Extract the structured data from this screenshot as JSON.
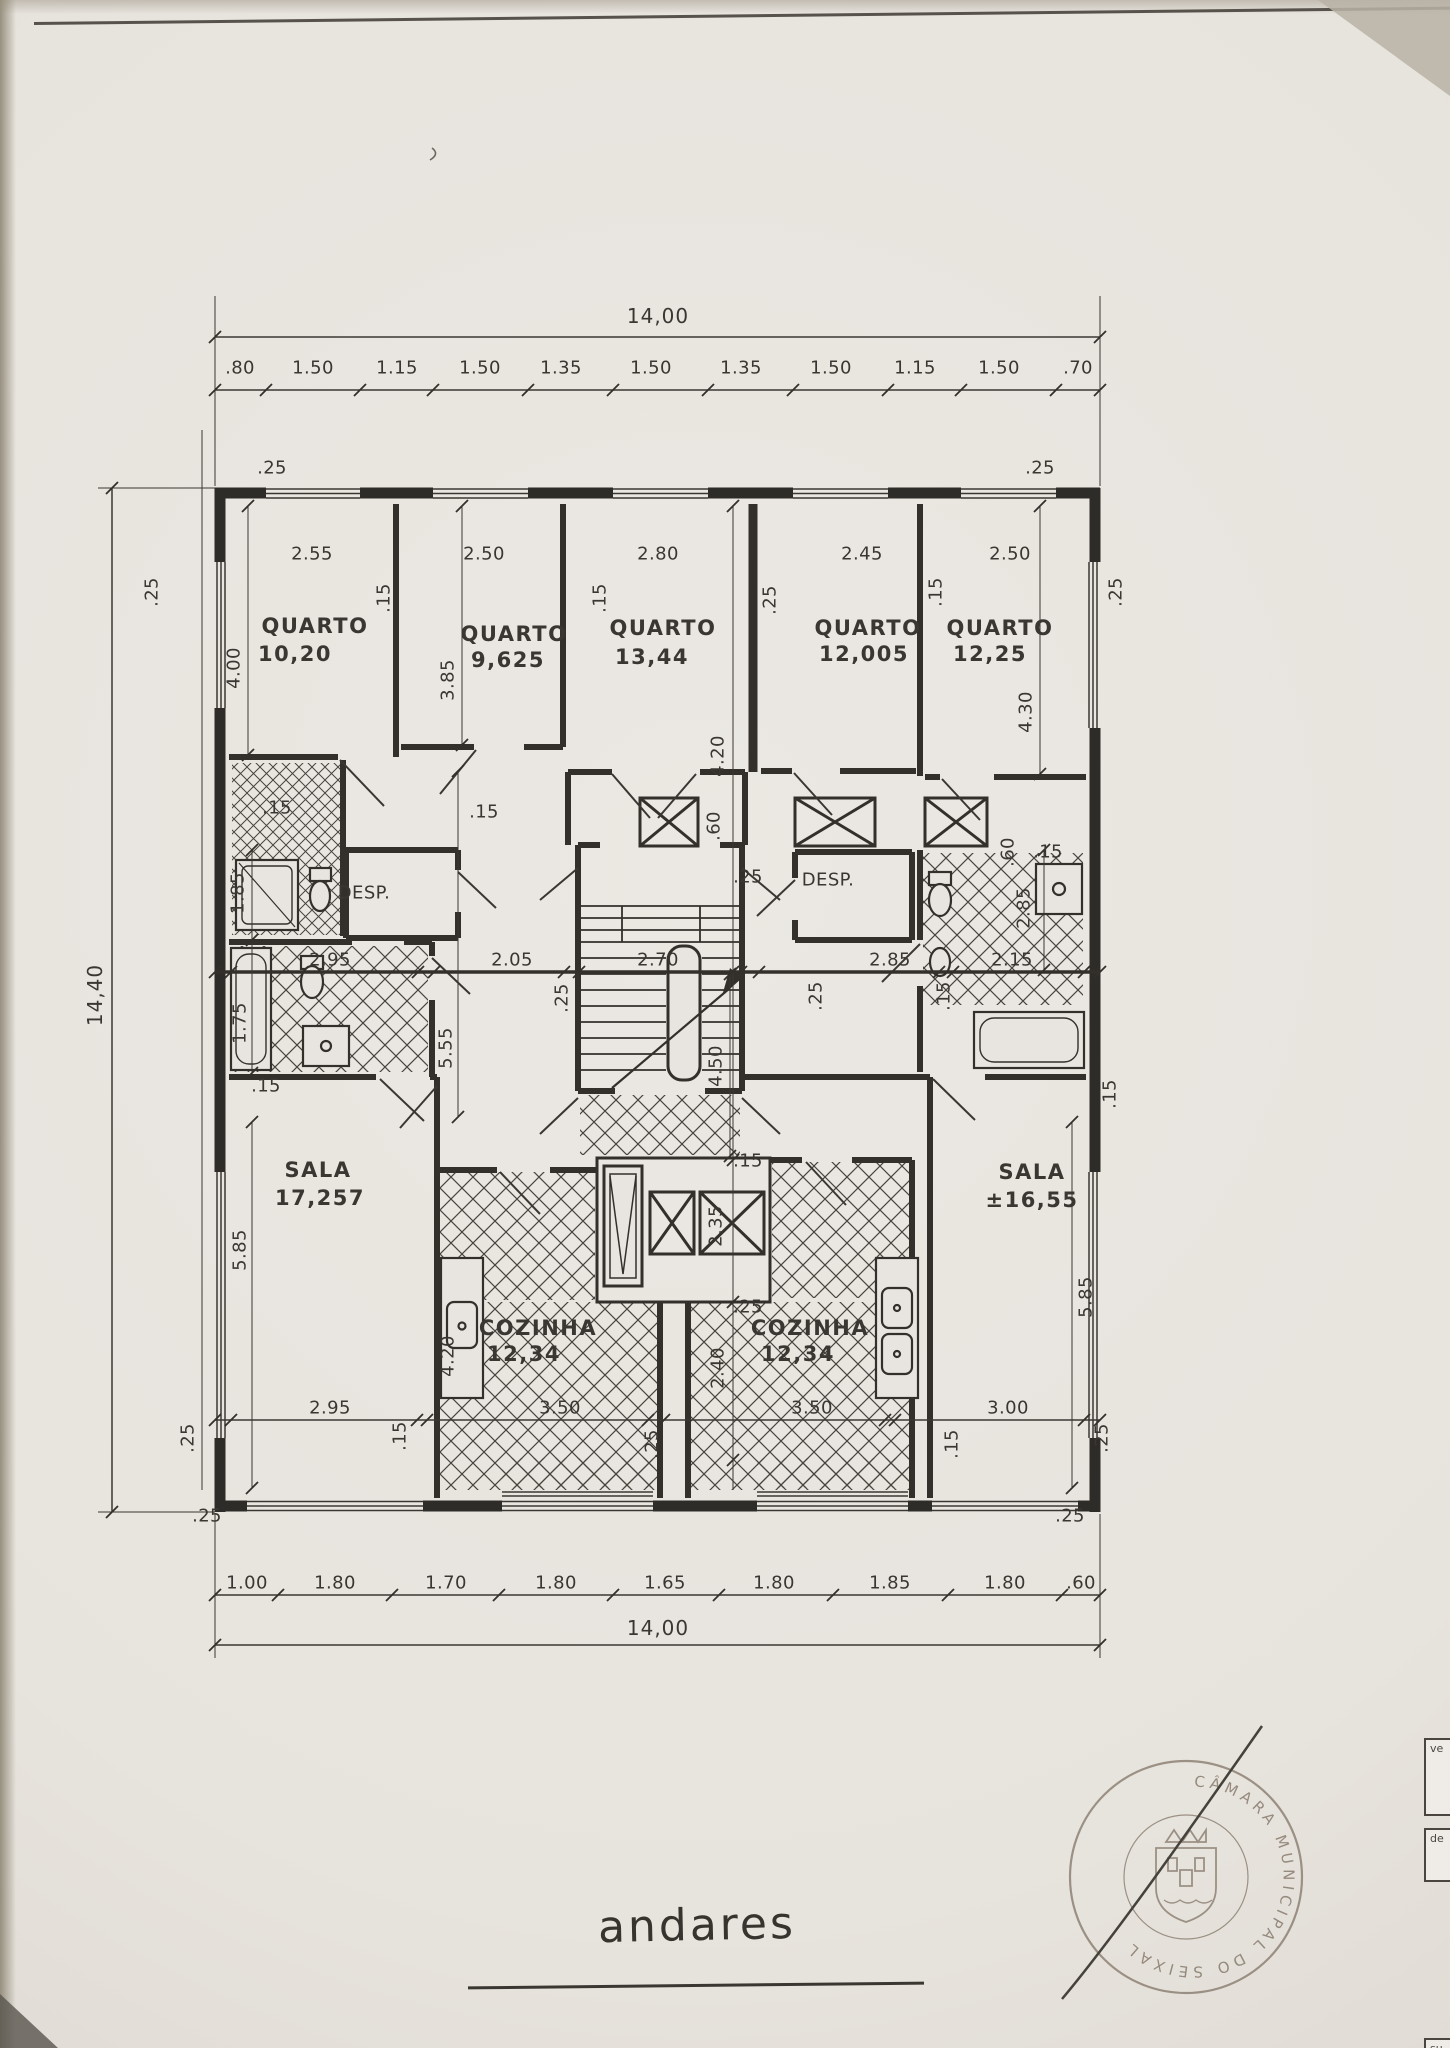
{
  "sheet": {
    "title": "andares",
    "paper_color": "#e8e5e0",
    "ink_color": "#3a3732"
  },
  "drawing": {
    "type": "floor-plan",
    "overall": {
      "width": "14,00",
      "height": "14,40"
    },
    "rooms": [
      {
        "label": "QUARTO",
        "area": "10,20"
      },
      {
        "label": "QUARTO",
        "area": "9,625"
      },
      {
        "label": "QUARTO",
        "area": "13,44"
      },
      {
        "label": "QUARTO",
        "area": "12,005"
      },
      {
        "label": "QUARTO",
        "area": "12,25"
      },
      {
        "label": "DESP."
      },
      {
        "label": "DESP."
      },
      {
        "label": "SALA",
        "area": "17,257"
      },
      {
        "label": "SALA",
        "area": "±16,55"
      },
      {
        "label": "COZINHA",
        "area": "12,34"
      },
      {
        "label": "COZINHA",
        "area": "12,34"
      }
    ],
    "top_chain": [
      ".80",
      "1.50",
      "1.15",
      "1.50",
      "1.35",
      "1.50",
      "1.35",
      "1.50",
      "1.15",
      "1.50",
      ".70"
    ],
    "bottom_chain": [
      "1.00",
      "1.80",
      "1.70",
      "1.80",
      "1.65",
      "1.80",
      "1.85",
      "1.80",
      ".60"
    ],
    "room_width_row": [
      "2.55",
      "2.50",
      "2.80",
      "2.45",
      "2.50"
    ],
    "middle_row": [
      "2.95",
      "2.05",
      "2.70",
      "2.85",
      "2.15"
    ],
    "room_depths": [
      "4.00",
      "3.85",
      "4.20",
      "4.30"
    ]
  },
  "stamp": {
    "ring_text": "CÂMARA MUNICIPAL DO SEIXAL",
    "accent_color": "#8e8275"
  },
  "side_tabs": [
    {
      "label": "ve"
    },
    {
      "label": "de"
    },
    {
      "label": "su"
    }
  ],
  "labels": [
    {
      "t": "14,00",
      "x": 658,
      "y": 316,
      "c": "t"
    },
    {
      "t": ".80",
      "x": 240,
      "y": 368
    },
    {
      "t": "1.50",
      "x": 313,
      "y": 368
    },
    {
      "t": "1.15",
      "x": 397,
      "y": 368
    },
    {
      "t": "1.50",
      "x": 480,
      "y": 368
    },
    {
      "t": "1.35",
      "x": 561,
      "y": 368
    },
    {
      "t": "1.50",
      "x": 651,
      "y": 368
    },
    {
      "t": "1.35",
      "x": 741,
      "y": 368
    },
    {
      "t": "1.50",
      "x": 831,
      "y": 368
    },
    {
      "t": "1.15",
      "x": 915,
      "y": 368
    },
    {
      "t": "1.50",
      "x": 999,
      "y": 368
    },
    {
      "t": ".70",
      "x": 1078,
      "y": 368
    },
    {
      "t": "14,40",
      "x": 95,
      "y": 995,
      "r": -90,
      "c": "t"
    },
    {
      "t": ".25",
      "x": 272,
      "y": 468
    },
    {
      "t": ".25",
      "x": 1040,
      "y": 468
    },
    {
      "t": ".25",
      "x": 152,
      "y": 592,
      "r": -90
    },
    {
      "t": ".25",
      "x": 1116,
      "y": 592,
      "r": -90
    },
    {
      "t": "2.55",
      "x": 312,
      "y": 554
    },
    {
      "t": "2.50",
      "x": 484,
      "y": 554
    },
    {
      "t": "2.80",
      "x": 658,
      "y": 554
    },
    {
      "t": "2.45",
      "x": 862,
      "y": 554
    },
    {
      "t": "2.50",
      "x": 1010,
      "y": 554
    },
    {
      "t": ".15",
      "x": 384,
      "y": 598,
      "r": -90
    },
    {
      "t": ".15",
      "x": 600,
      "y": 598,
      "r": -90
    },
    {
      "t": ".25",
      "x": 770,
      "y": 600,
      "r": -90
    },
    {
      "t": ".15",
      "x": 936,
      "y": 592,
      "r": -90
    },
    {
      "t": "4.00",
      "x": 234,
      "y": 668,
      "r": -90
    },
    {
      "t": "3.85",
      "x": 448,
      "y": 680,
      "r": -90
    },
    {
      "t": "4.20",
      "x": 718,
      "y": 756,
      "r": -90
    },
    {
      "t": "4.30",
      "x": 1026,
      "y": 712,
      "r": -90
    },
    {
      "t": "QUARTO",
      "x": 315,
      "y": 626,
      "c": "r"
    },
    {
      "t": "10,20",
      "x": 295,
      "y": 654,
      "c": "r"
    },
    {
      "t": "QUARTO",
      "x": 514,
      "y": 634,
      "c": "r"
    },
    {
      "t": "9,625",
      "x": 508,
      "y": 660,
      "c": "r"
    },
    {
      "t": "QUARTO",
      "x": 663,
      "y": 628,
      "c": "r"
    },
    {
      "t": "13,44",
      "x": 652,
      "y": 657,
      "c": "r"
    },
    {
      "t": "QUARTO",
      "x": 868,
      "y": 628,
      "c": "r"
    },
    {
      "t": "12,005",
      "x": 864,
      "y": 654,
      "c": "r"
    },
    {
      "t": "QUARTO",
      "x": 1000,
      "y": 628,
      "c": "r"
    },
    {
      "t": "12,25",
      "x": 990,
      "y": 654,
      "c": "r"
    },
    {
      "t": ".15",
      "x": 277,
      "y": 808
    },
    {
      "t": ".15",
      "x": 484,
      "y": 812
    },
    {
      "t": "1.85",
      "x": 238,
      "y": 893,
      "r": -90
    },
    {
      "t": "DESP.",
      "x": 364,
      "y": 893
    },
    {
      "t": ".25",
      "x": 748,
      "y": 877
    },
    {
      "t": "DESP.",
      "x": 828,
      "y": 880
    },
    {
      "t": ".60",
      "x": 714,
      "y": 826,
      "r": -90
    },
    {
      "t": ".60",
      "x": 1008,
      "y": 852,
      "r": -90
    },
    {
      "t": ".15",
      "x": 1048,
      "y": 852
    },
    {
      "t": "2.85",
      "x": 1024,
      "y": 908,
      "r": -90
    },
    {
      "t": "2.95",
      "x": 330,
      "y": 960
    },
    {
      "t": "2.05",
      "x": 512,
      "y": 960
    },
    {
      "t": "2.70",
      "x": 658,
      "y": 960
    },
    {
      "t": "2.85",
      "x": 890,
      "y": 960
    },
    {
      "t": "2.15",
      "x": 1012,
      "y": 960
    },
    {
      "t": ".25",
      "x": 562,
      "y": 998,
      "r": -90
    },
    {
      "t": ".25",
      "x": 816,
      "y": 996,
      "r": -90
    },
    {
      "t": ".15",
      "x": 944,
      "y": 996,
      "r": -90
    },
    {
      "t": "1.75",
      "x": 240,
      "y": 1023,
      "r": -90
    },
    {
      "t": "5.55",
      "x": 446,
      "y": 1048,
      "r": -90
    },
    {
      "t": "4.50",
      "x": 716,
      "y": 1066,
      "r": -90
    },
    {
      "t": ".15",
      "x": 266,
      "y": 1086
    },
    {
      "t": ".15",
      "x": 748,
      "y": 1161
    },
    {
      "t": ".15",
      "x": 1110,
      "y": 1094,
      "r": -90
    },
    {
      "t": "SALA",
      "x": 318,
      "y": 1170,
      "c": "r"
    },
    {
      "t": "17,257",
      "x": 320,
      "y": 1198,
      "c": "r"
    },
    {
      "t": "SALA",
      "x": 1032,
      "y": 1172,
      "c": "r"
    },
    {
      "t": "±16,55",
      "x": 1032,
      "y": 1200,
      "c": "r"
    },
    {
      "t": "5.85",
      "x": 240,
      "y": 1250,
      "r": -90
    },
    {
      "t": "5.85",
      "x": 1086,
      "y": 1297,
      "r": -90
    },
    {
      "t": "COZINHA",
      "x": 538,
      "y": 1328,
      "c": "r"
    },
    {
      "t": "12,34",
      "x": 524,
      "y": 1354,
      "c": "r"
    },
    {
      "t": "COZINHA",
      "x": 810,
      "y": 1328,
      "c": "r"
    },
    {
      "t": "12,34",
      "x": 798,
      "y": 1354,
      "c": "r"
    },
    {
      "t": "4.20",
      "x": 448,
      "y": 1356,
      "r": -90
    },
    {
      "t": "2.35",
      "x": 716,
      "y": 1226,
      "r": -90
    },
    {
      "t": ".25",
      "x": 748,
      "y": 1307
    },
    {
      "t": "2.40",
      "x": 718,
      "y": 1368,
      "r": -90
    },
    {
      "t": "2.95",
      "x": 330,
      "y": 1408
    },
    {
      "t": "3.50",
      "x": 560,
      "y": 1408
    },
    {
      "t": "3.50",
      "x": 812,
      "y": 1408
    },
    {
      "t": "3.00",
      "x": 1008,
      "y": 1408
    },
    {
      "t": ".25",
      "x": 188,
      "y": 1438,
      "r": -90
    },
    {
      "t": ".15",
      "x": 400,
      "y": 1436,
      "r": -90
    },
    {
      "t": ".25",
      "x": 652,
      "y": 1444,
      "r": -90
    },
    {
      "t": ".15",
      "x": 952,
      "y": 1444,
      "r": -90
    },
    {
      "t": ".25",
      "x": 1102,
      "y": 1438,
      "r": -90
    },
    {
      "t": ".25",
      "x": 207,
      "y": 1516
    },
    {
      "t": ".25",
      "x": 1070,
      "y": 1516
    },
    {
      "t": "1.00",
      "x": 247,
      "y": 1583
    },
    {
      "t": "1.80",
      "x": 335,
      "y": 1583
    },
    {
      "t": "1.70",
      "x": 446,
      "y": 1583
    },
    {
      "t": "1.80",
      "x": 556,
      "y": 1583
    },
    {
      "t": "1.65",
      "x": 665,
      "y": 1583
    },
    {
      "t": "1.80",
      "x": 774,
      "y": 1583
    },
    {
      "t": "1.85",
      "x": 890,
      "y": 1583
    },
    {
      "t": "1.80",
      "x": 1005,
      "y": 1583
    },
    {
      "t": ".60",
      "x": 1081,
      "y": 1583
    },
    {
      "t": "14,00",
      "x": 658,
      "y": 1628,
      "c": "t"
    }
  ]
}
